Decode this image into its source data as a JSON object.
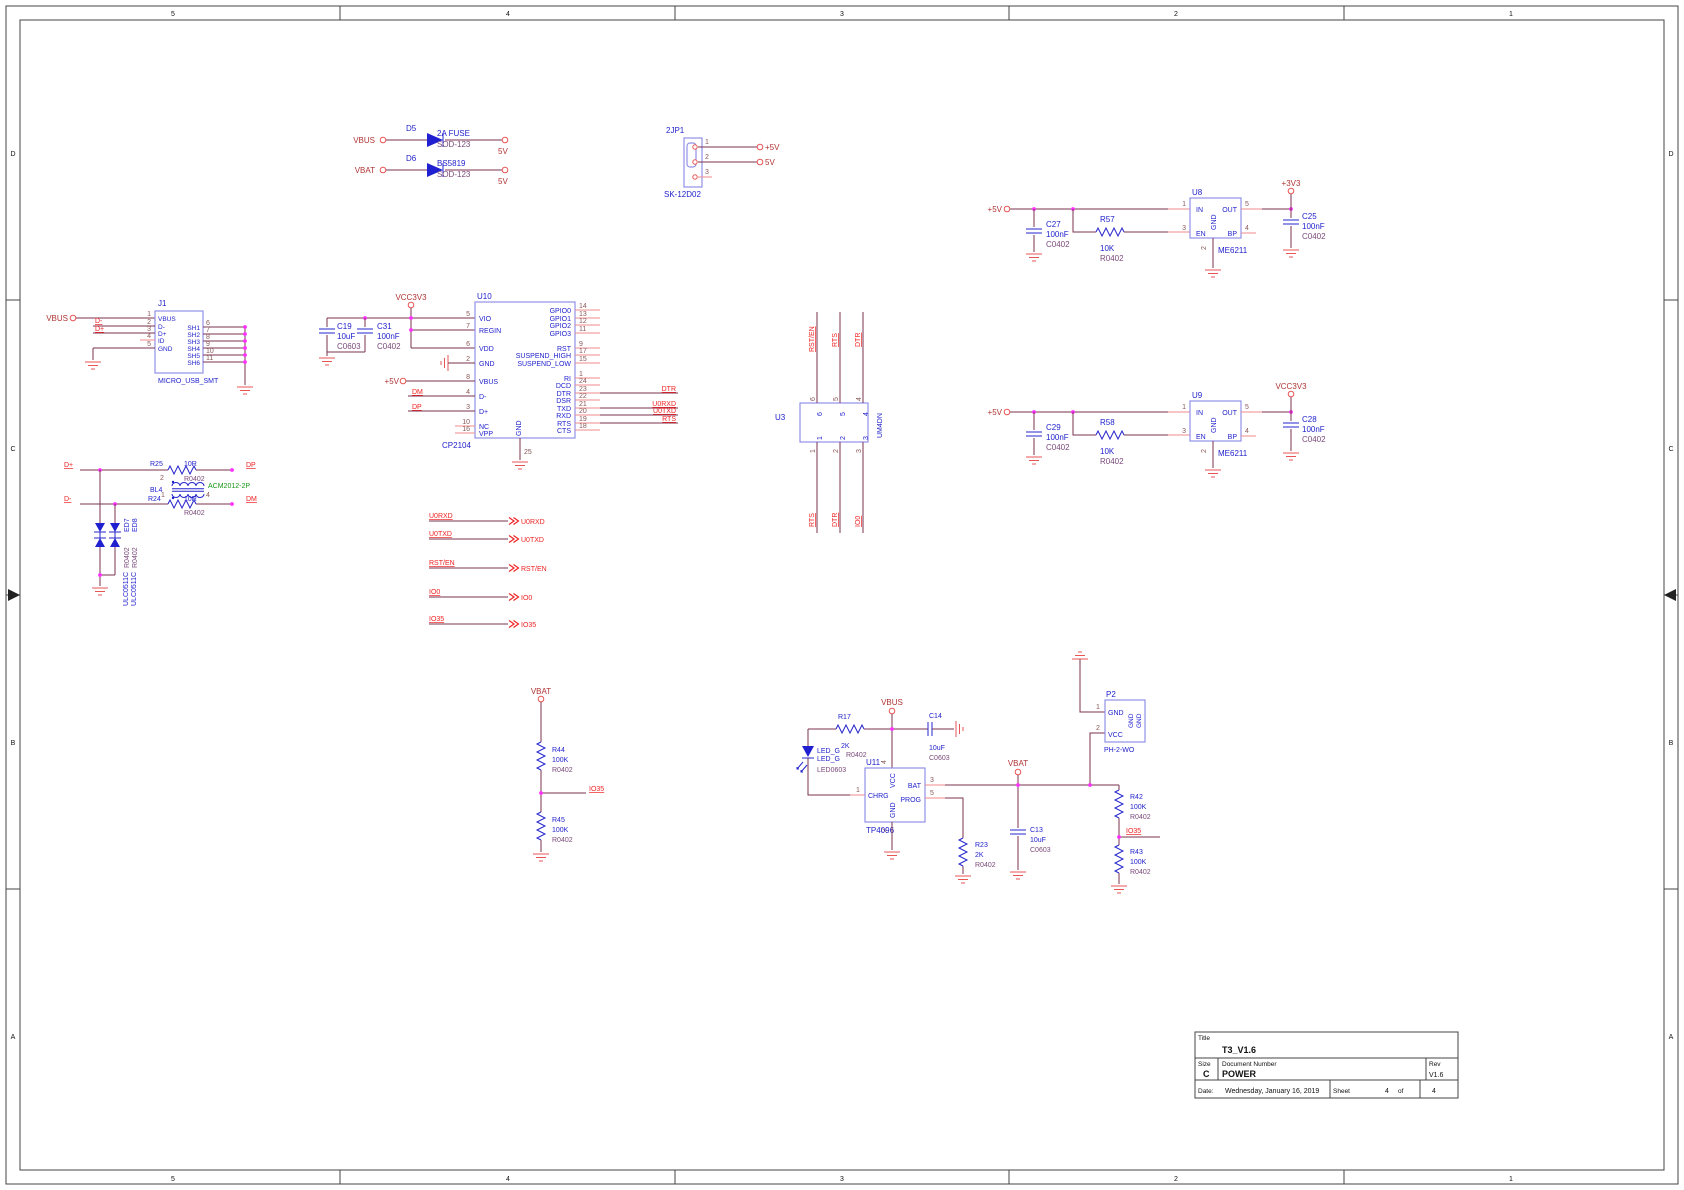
{
  "frame": {
    "cols": [
      "5",
      "4",
      "3",
      "2",
      "1"
    ],
    "rows": [
      "D",
      "C",
      "B",
      "A"
    ]
  },
  "pwr": {
    "vbus": "VBUS",
    "vbat": "VBAT",
    "v5a": "5V",
    "v5b": "5V",
    "d5": {
      "ref": "D5",
      "val": "2A FUSE",
      "fp": "SOD-123"
    },
    "d6": {
      "ref": "D6",
      "val": "BS5819",
      "fp": "SOD-123"
    }
  },
  "jp1": {
    "ref": "2JP1",
    "fp": "SK-12D02",
    "p1": "1",
    "p2": "2",
    "p3": "3",
    "n1": "+5V",
    "n2": "5V"
  },
  "u8": {
    "ref": "U8",
    "part": "ME6211",
    "in": "IN",
    "out": "OUT",
    "en": "EN",
    "gnd": "GND",
    "bp": "BP",
    "n1": "1",
    "n2": "2",
    "n3": "3",
    "n4": "4",
    "n5": "5",
    "vin": "+5V",
    "vout": "+3V3",
    "c_in": {
      "ref": "C27",
      "val": "100nF",
      "fp": "C0402"
    },
    "r": {
      "ref": "R57",
      "val": "10K",
      "fp": "R0402"
    },
    "c_out": {
      "ref": "C25",
      "val": "100nF",
      "fp": "C0402"
    }
  },
  "u9": {
    "ref": "U9",
    "part": "ME6211",
    "in": "IN",
    "out": "OUT",
    "en": "EN",
    "gnd": "GND",
    "bp": "BP",
    "n1": "1",
    "n2": "2",
    "n3": "3",
    "n4": "4",
    "n5": "5",
    "vin": "+5V",
    "vout": "VCC3V3",
    "c_in": {
      "ref": "C29",
      "val": "100nF",
      "fp": "C0402"
    },
    "r": {
      "ref": "R58",
      "val": "10K",
      "fp": "R0402"
    },
    "c_out": {
      "ref": "C28",
      "val": "100nF",
      "fp": "C0402"
    }
  },
  "j1": {
    "ref": "J1",
    "fp": "MICRO_USB_SMT",
    "port": "VBUS",
    "ndm": "D-",
    "ndp": "D+",
    "left": [
      {
        "n": "1",
        "t": "VBUS"
      },
      {
        "n": "2",
        "t": "D-"
      },
      {
        "n": "3",
        "t": "D+"
      },
      {
        "n": "4",
        "t": "ID"
      },
      {
        "n": "5",
        "t": "GND"
      }
    ],
    "right": [
      {
        "n": "6",
        "t": "SH1"
      },
      {
        "n": "7",
        "t": "SH2"
      },
      {
        "n": "8",
        "t": "SH3"
      },
      {
        "n": "9",
        "t": "SH4"
      },
      {
        "n": "10",
        "t": "SH5"
      },
      {
        "n": "11",
        "t": "SH6"
      }
    ]
  },
  "u10": {
    "ref": "U10",
    "part": "CP2104",
    "pwr": "VCC3V3",
    "v5": "+5V",
    "ndm": "DM",
    "ndp": "DP",
    "ndtr": "DTR",
    "ntxd": "U0RXD",
    "nrxd": "U0TXD",
    "nrts": "RTS",
    "bn": "25",
    "bt": "GND",
    "left": [
      {
        "n": "5",
        "t": "VIO"
      },
      {
        "n": "7",
        "t": "REGIN"
      },
      {
        "n": "6",
        "t": "VDD"
      },
      {
        "n": "2",
        "t": "GND"
      },
      {
        "n": "8",
        "t": "VBUS"
      },
      {
        "n": "4",
        "t": "D-"
      },
      {
        "n": "3",
        "t": "D+"
      },
      {
        "n": "10",
        "t": "NC"
      },
      {
        "n": "16",
        "t": "VPP"
      }
    ],
    "right": [
      {
        "n": "14",
        "t": "GPIO0"
      },
      {
        "n": "13",
        "t": "GPIO1"
      },
      {
        "n": "12",
        "t": "GPIO2"
      },
      {
        "n": "11",
        "t": "GPIO3"
      },
      {
        "n": "9",
        "t": "RST"
      },
      {
        "n": "17",
        "t": "SUSPEND_HIGH"
      },
      {
        "n": "15",
        "t": "SUSPEND_LOW"
      },
      {
        "n": "1",
        "t": "RI"
      },
      {
        "n": "24",
        "t": "DCD"
      },
      {
        "n": "23",
        "t": "DTR"
      },
      {
        "n": "22",
        "t": "DSR"
      },
      {
        "n": "21",
        "t": "TXD"
      },
      {
        "n": "20",
        "t": "RXD"
      },
      {
        "n": "19",
        "t": "RTS"
      },
      {
        "n": "18",
        "t": "CTS"
      }
    ],
    "c19": {
      "ref": "C19",
      "val": "10uF",
      "fp": "C0603"
    },
    "c31": {
      "ref": "C31",
      "val": "100nF",
      "fp": "C0402"
    }
  },
  "u3": {
    "ref": "U3",
    "part": "UM4DN",
    "top": [
      {
        "n": "6",
        "net": "RST/EN"
      },
      {
        "n": "5",
        "net": "RTS"
      },
      {
        "n": "4",
        "net": "DTR"
      }
    ],
    "bot": [
      {
        "n": "1",
        "net": "RTS"
      },
      {
        "n": "2",
        "net": "DTR"
      },
      {
        "n": "3",
        "net": "IO0"
      }
    ]
  },
  "filt": {
    "dp": "D+",
    "dm": "D-",
    "odp": "DP",
    "odm": "DM",
    "r25": {
      "ref": "R25",
      "val": "10R",
      "fp": "R0402",
      "pn": "2"
    },
    "r24": {
      "ref": "R24",
      "val": "10R",
      "fp": "R0402"
    },
    "bl4": {
      "ref": "BL4",
      "part": "ACM2012-2P",
      "p1": "1",
      "p4": "4"
    },
    "ed7": "ED7",
    "ed8": "ED8",
    "fp1": "R0402",
    "fp2": "R0402",
    "pt1": "ULC0511C",
    "pt2": "ULC0511C"
  },
  "off": {
    "rows": [
      {
        "l": "U0RXD"
      },
      {
        "l": "U0TXD"
      },
      {
        "l": "RST/EN"
      },
      {
        "l": "IO0"
      },
      {
        "l": "IO35"
      }
    ]
  },
  "div": {
    "pwr": "VBAT",
    "net": "IO35",
    "r44": {
      "ref": "R44",
      "val": "100K",
      "fp": "R0402"
    },
    "r45": {
      "ref": "R45",
      "val": "100K",
      "fp": "R0402"
    }
  },
  "chg": {
    "vbus": "VBUS",
    "vbat": "VBAT",
    "io35": "IO35",
    "r17": {
      "ref": "R17",
      "val": "2K",
      "fp": "R0402"
    },
    "led": {
      "ref": "LED_G",
      "val": "LED_G",
      "fp": "LED0603"
    },
    "c14": {
      "ref": "C14",
      "val": "10uF",
      "fp": "C0603"
    },
    "u11": {
      "ref": "U11",
      "part": "TP4096",
      "chrg": "CHRG",
      "vcc": "VCC",
      "bat": "BAT",
      "prog": "PROG",
      "gnd": "GND",
      "n1": "1",
      "n2": "2",
      "n3": "3",
      "n4": "4",
      "n5": "5"
    },
    "r23": {
      "ref": "R23",
      "val": "2K",
      "fp": "R0402"
    },
    "c13": {
      "ref": "C13",
      "val": "10uF",
      "fp": "C0603"
    },
    "r42": {
      "ref": "R42",
      "val": "100K",
      "fp": "R0402"
    },
    "r43": {
      "ref": "R43",
      "val": "100K",
      "fp": "R0402"
    }
  },
  "p2": {
    "ref": "P2",
    "fp": "PH-2-WO",
    "gnd": "GND",
    "vcc": "VCC",
    "n1": "1",
    "n2": "2",
    "s1": "GND",
    "s2": "GND"
  },
  "tb": {
    "title_l": "Title",
    "title": "T3_V1.6",
    "size_l": "Size",
    "size": "C",
    "doc_l": "Document Number",
    "doc": "POWER",
    "rev_l": "Rev",
    "rev": "V1.6",
    "date_l": "Date:",
    "date": "Wednesday, January 16, 2019",
    "sheet_l": "Sheet",
    "sheet": "4",
    "of": "of",
    "total": "4"
  }
}
